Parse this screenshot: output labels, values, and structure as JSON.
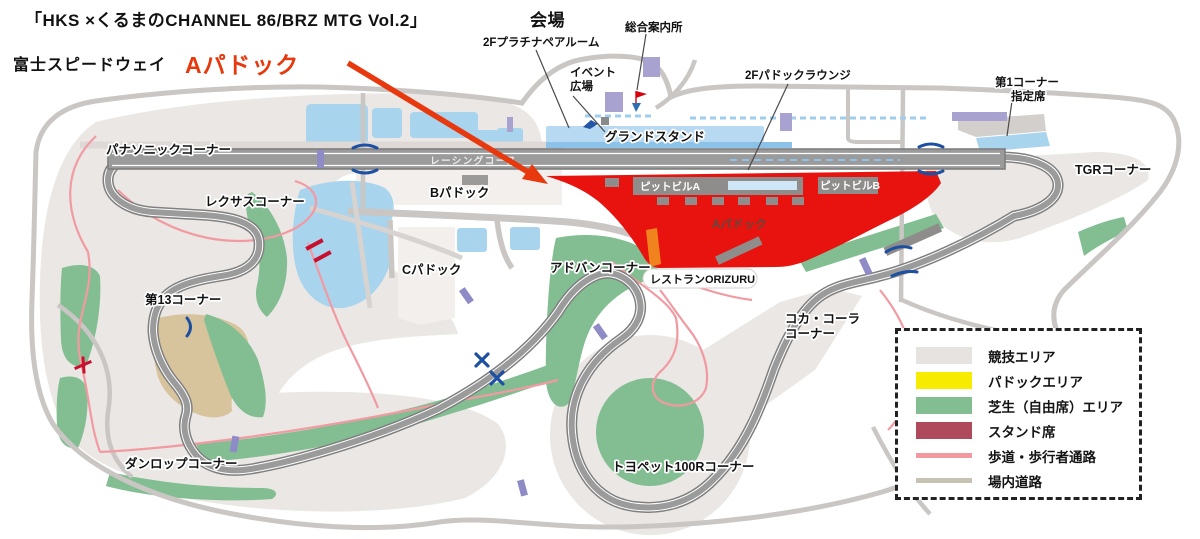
{
  "title": {
    "event": "「HKS ×くるまのCHANNEL 86/BRZ MTG Vol.2」",
    "venue_suffix": "会場",
    "circuit": "富士スピードウェイ",
    "highlight": "Aパドック"
  },
  "map": {
    "labels": {
      "platinum_room": "2Fプラチナペアルーム",
      "info_center": "総合案内所",
      "event_plaza_1": "イベント",
      "event_plaza_2": "広場",
      "paddock_lounge": "2Fパドックラウンジ",
      "first_corner_1": "第1コーナー",
      "first_corner_2": "指定席",
      "grandstand": "グランドスタンド",
      "racing_course": "レーシングコース",
      "panasonic": "パナソニックコーナー",
      "lexus": "レクサスコーナー",
      "corner13": "第13コーナー",
      "dunlop": "ダンロップコーナー",
      "advan": "アドバンコーナー",
      "toyopet": "トヨペット100Rコーナー",
      "cocacola_1": "コカ・コーラ",
      "cocacola_2": "コーナー",
      "tgr": "TGRコーナー",
      "b_paddock": "Bパドック",
      "c_paddock": "Cパドック",
      "a_paddock": "Aパドック",
      "pit_a": "ピットビルA",
      "pit_b": "ピットビルB",
      "restaurant": "レストランORIZURU"
    }
  },
  "legend": {
    "items": [
      {
        "label": "競技エリア",
        "color": "#e6e3e1",
        "type": "area"
      },
      {
        "label": "パドックエリア",
        "color": "#f7ec00",
        "type": "area"
      },
      {
        "label": "芝生（自由席）エリア",
        "color": "#82be92",
        "type": "area"
      },
      {
        "label": "スタンド席",
        "color": "#ae4a5c",
        "type": "area"
      },
      {
        "label": "歩道・歩行者通路",
        "color": "#f2989f",
        "type": "line"
      },
      {
        "label": "場内道路",
        "color": "#c6c3b2",
        "type": "line"
      }
    ]
  },
  "colors": {
    "a_paddock_red": "#e8130e",
    "arrow_red": "#e8380d",
    "lawn_green": "#82be92",
    "water_parking_blue": "#a9d4ee",
    "competition_gray": "#eae7e4",
    "track_gray": "#9b9b9b",
    "tan_bank": "#d8c49c",
    "building_lavender": "#a8a2d0",
    "walkway_pink": "#f29aa2",
    "road_gray": "#c9c6c4"
  }
}
